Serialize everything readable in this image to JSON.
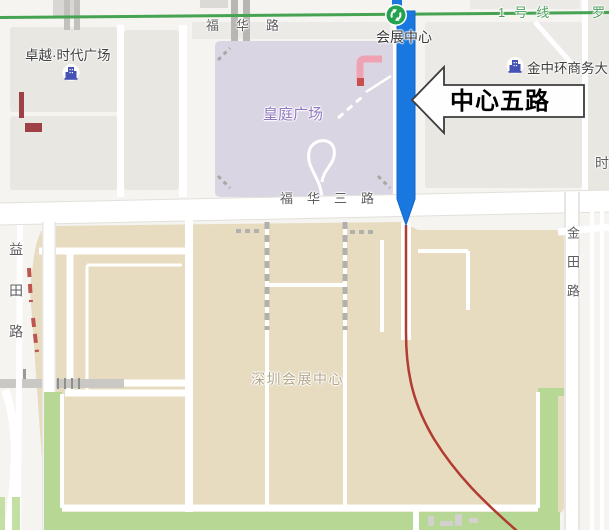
{
  "window": {
    "width": 609,
    "height": 530
  },
  "map": {
    "callout": {
      "label": "中心五路"
    },
    "metro": {
      "line_name": "1号线",
      "line_name_partial": "罗",
      "station_name": "会展中心"
    },
    "road_labels": {
      "fuhua": "福华路",
      "fuhua_san": "福华三路",
      "yitian": "益田路",
      "jintian": "金田路",
      "partial_right_edge": "时"
    },
    "poi_labels": {
      "zhuoyue": "卓越·时代广场",
      "jinzhonghuan": "金中环商务大",
      "huangting": "皇庭广场",
      "shenzhen_convention_center": "深圳会展中心"
    },
    "colors": {
      "highlight_road": "#1878e0",
      "metro_line": "#45a351",
      "metro_text": "#4fa05e",
      "route_line": "#b23b32",
      "convention_area": "#e7dbc0",
      "plaza_area": "#d9d5e3",
      "green_belt": "#b6d894",
      "block_gray": "#e9e7e2",
      "convention_label_text": "#b3a78a",
      "plaza_label_text": "#8f78bf"
    }
  }
}
